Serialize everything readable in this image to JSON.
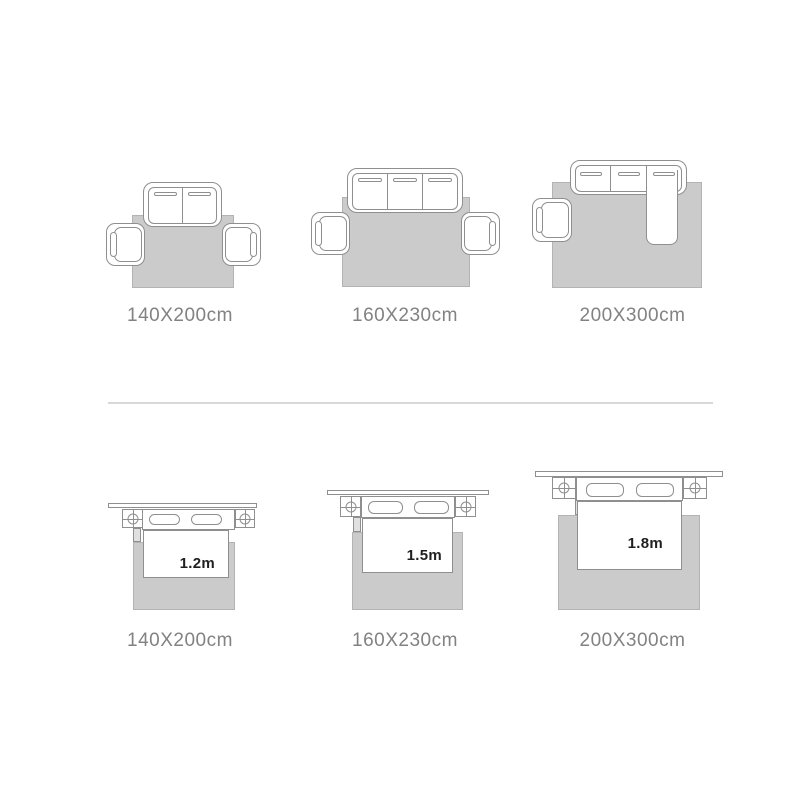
{
  "colors": {
    "bg": "#ffffff",
    "rug_fill": "#cbcbcb",
    "rug_border": "#b3b3b3",
    "outline": "#8f8f8f",
    "label_text": "#828282",
    "dim_label_text": "#1f1f1f",
    "divider": "#d8d8d8",
    "leg_fill": "#e0e0e0"
  },
  "sofa_row": {
    "items": [
      {
        "label": "140X200cm"
      },
      {
        "label": "160X230cm"
      },
      {
        "label": "200X300cm"
      }
    ]
  },
  "bed_row": {
    "items": [
      {
        "label": "140X200cm",
        "bed_width": "1.2m"
      },
      {
        "label": "160X230cm",
        "bed_width": "1.5m"
      },
      {
        "label": "200X300cm",
        "bed_width": "1.8m"
      }
    ]
  }
}
